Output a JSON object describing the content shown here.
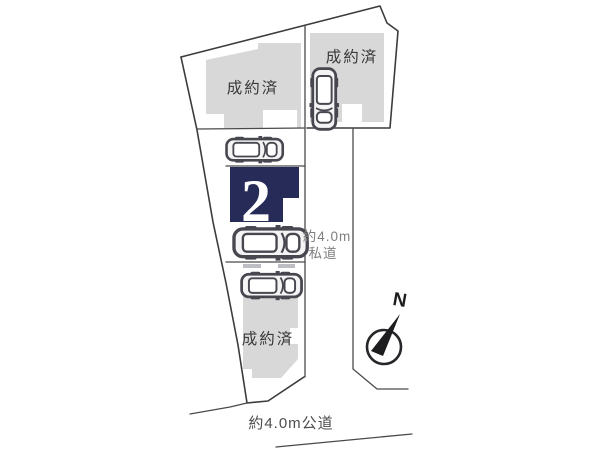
{
  "diagram": {
    "kind": "residential-site-plan",
    "background": "#ffffff"
  },
  "colors": {
    "highlight_navy": "#272b58",
    "building_gray": "#d8d8d8",
    "boundary_line": "#3c3c3c",
    "status_text": "#3a3a3a",
    "private_road_text": "#7f7f7f",
    "public_road_text": "#4d4d4d",
    "car_outline": "#474750",
    "lot_number_text": "#ffffff",
    "compass_ink": "#1d1d20"
  },
  "lots": [
    {
      "id": "lot-top-left",
      "status": "成約済"
    },
    {
      "id": "lot-top-right",
      "status": "成約済"
    },
    {
      "id": "lot-2",
      "number": "2"
    },
    {
      "id": "lot-bottom",
      "status": "成約済"
    }
  ],
  "roads": {
    "private": {
      "label_line1": "約4.0m",
      "label_line2": "私道"
    },
    "public": {
      "label": "約4.0m公道"
    }
  },
  "compass": {
    "label": "N"
  },
  "icons": {
    "car": "car-top-view-icon",
    "compass": "north-arrow-icon"
  }
}
